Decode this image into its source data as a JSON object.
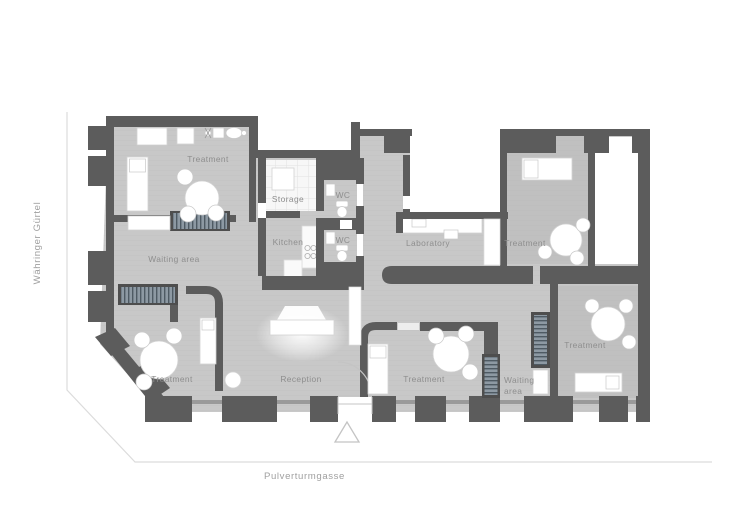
{
  "plan": {
    "title": "dental-practice-floor-plan",
    "rooms": {
      "treatment_top_left": "Treatment",
      "storage": "Storage",
      "wc_upper": "WC",
      "kitchen": "Kitchen",
      "wc_lower": "WC",
      "waiting_left": "Waiting area",
      "laboratory": "Laboratory",
      "treatment_right": "Treatment",
      "treatment_bottom_left": "Treatment",
      "reception": "Reception",
      "treatment_bottom_center": "Treatment",
      "waiting_right_line1": "Waiting",
      "waiting_right_line2": "area",
      "treatment_bottom_right": "Treatment"
    },
    "streets": {
      "left": "Währinger Gürtel",
      "bottom": "Pulverturmgasse"
    },
    "colors": {
      "wall": "#5c5c5c",
      "floor": "#c8c8c8",
      "room_label": "#8e8e8e",
      "street_label": "#a0a0a0",
      "street_line": "#dcdcdc",
      "bench_stripes": "#8d99a3",
      "furniture": "#ffffff"
    }
  }
}
